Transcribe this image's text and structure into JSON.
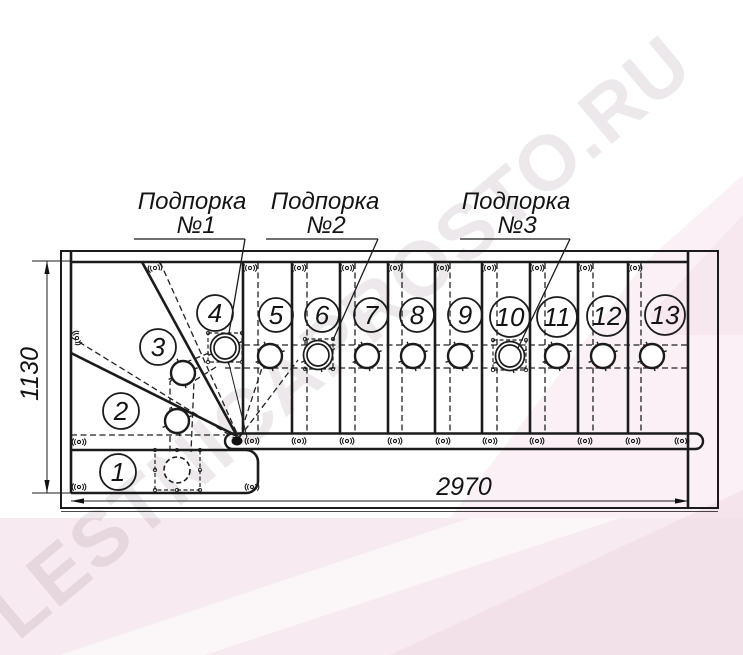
{
  "watermark": {
    "text": "LESTNICAPROSTO.RU"
  },
  "supports": [
    {
      "title": "Подпорка",
      "num": "№1"
    },
    {
      "title": "Подпорка",
      "num": "№2"
    },
    {
      "title": "Подпорка",
      "num": "№3"
    }
  ],
  "dimensions": {
    "length": "2970",
    "width": "1130"
  },
  "steps": [
    "1",
    "2",
    "3",
    "4",
    "5",
    "6",
    "7",
    "8",
    "9",
    "10",
    "11",
    "12",
    "13"
  ],
  "colors": {
    "line": "#1b1b1b",
    "pink_base": "#f7eaf0",
    "pink_band": "#f3dce8",
    "watermark": "rgba(150,118,134,0.17)"
  }
}
